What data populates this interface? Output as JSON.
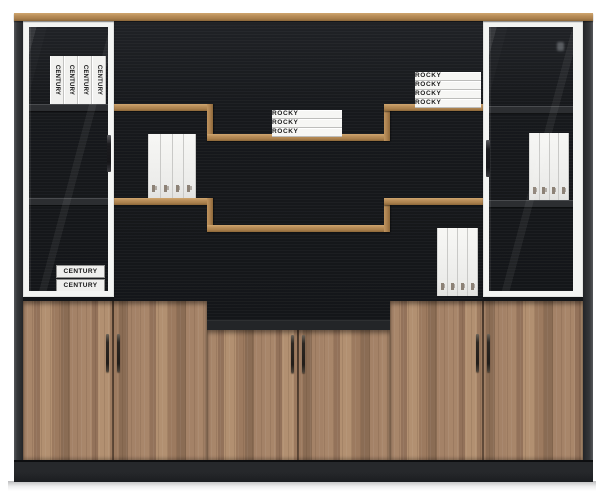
{
  "books": {
    "century_spines": [
      "CENTURY",
      "CENTURY",
      "CENTURY",
      "CENTURY"
    ],
    "century_stack": [
      "CENTURY",
      "CENTURY"
    ],
    "rocky_left": [
      "ROCKY",
      "ROCKY",
      "ROCKY"
    ],
    "rocky_right": [
      "ROCKY",
      "ROCKY",
      "ROCKY",
      "ROCKY"
    ],
    "binder_counts": {
      "middle_left": 4,
      "bottom_right": 4,
      "right_cabinet": 4
    }
  },
  "colors": {
    "background": "#ffffff",
    "wood_trim": "#b88d58",
    "door_wood": "#9c7a5f",
    "interior_black": "#17191c",
    "frame_white": "#f3f4f2",
    "side_panel": "#35373a",
    "base": "#26282b",
    "book_white": "#f4f4f2",
    "book_text": "#1b1b1b"
  }
}
